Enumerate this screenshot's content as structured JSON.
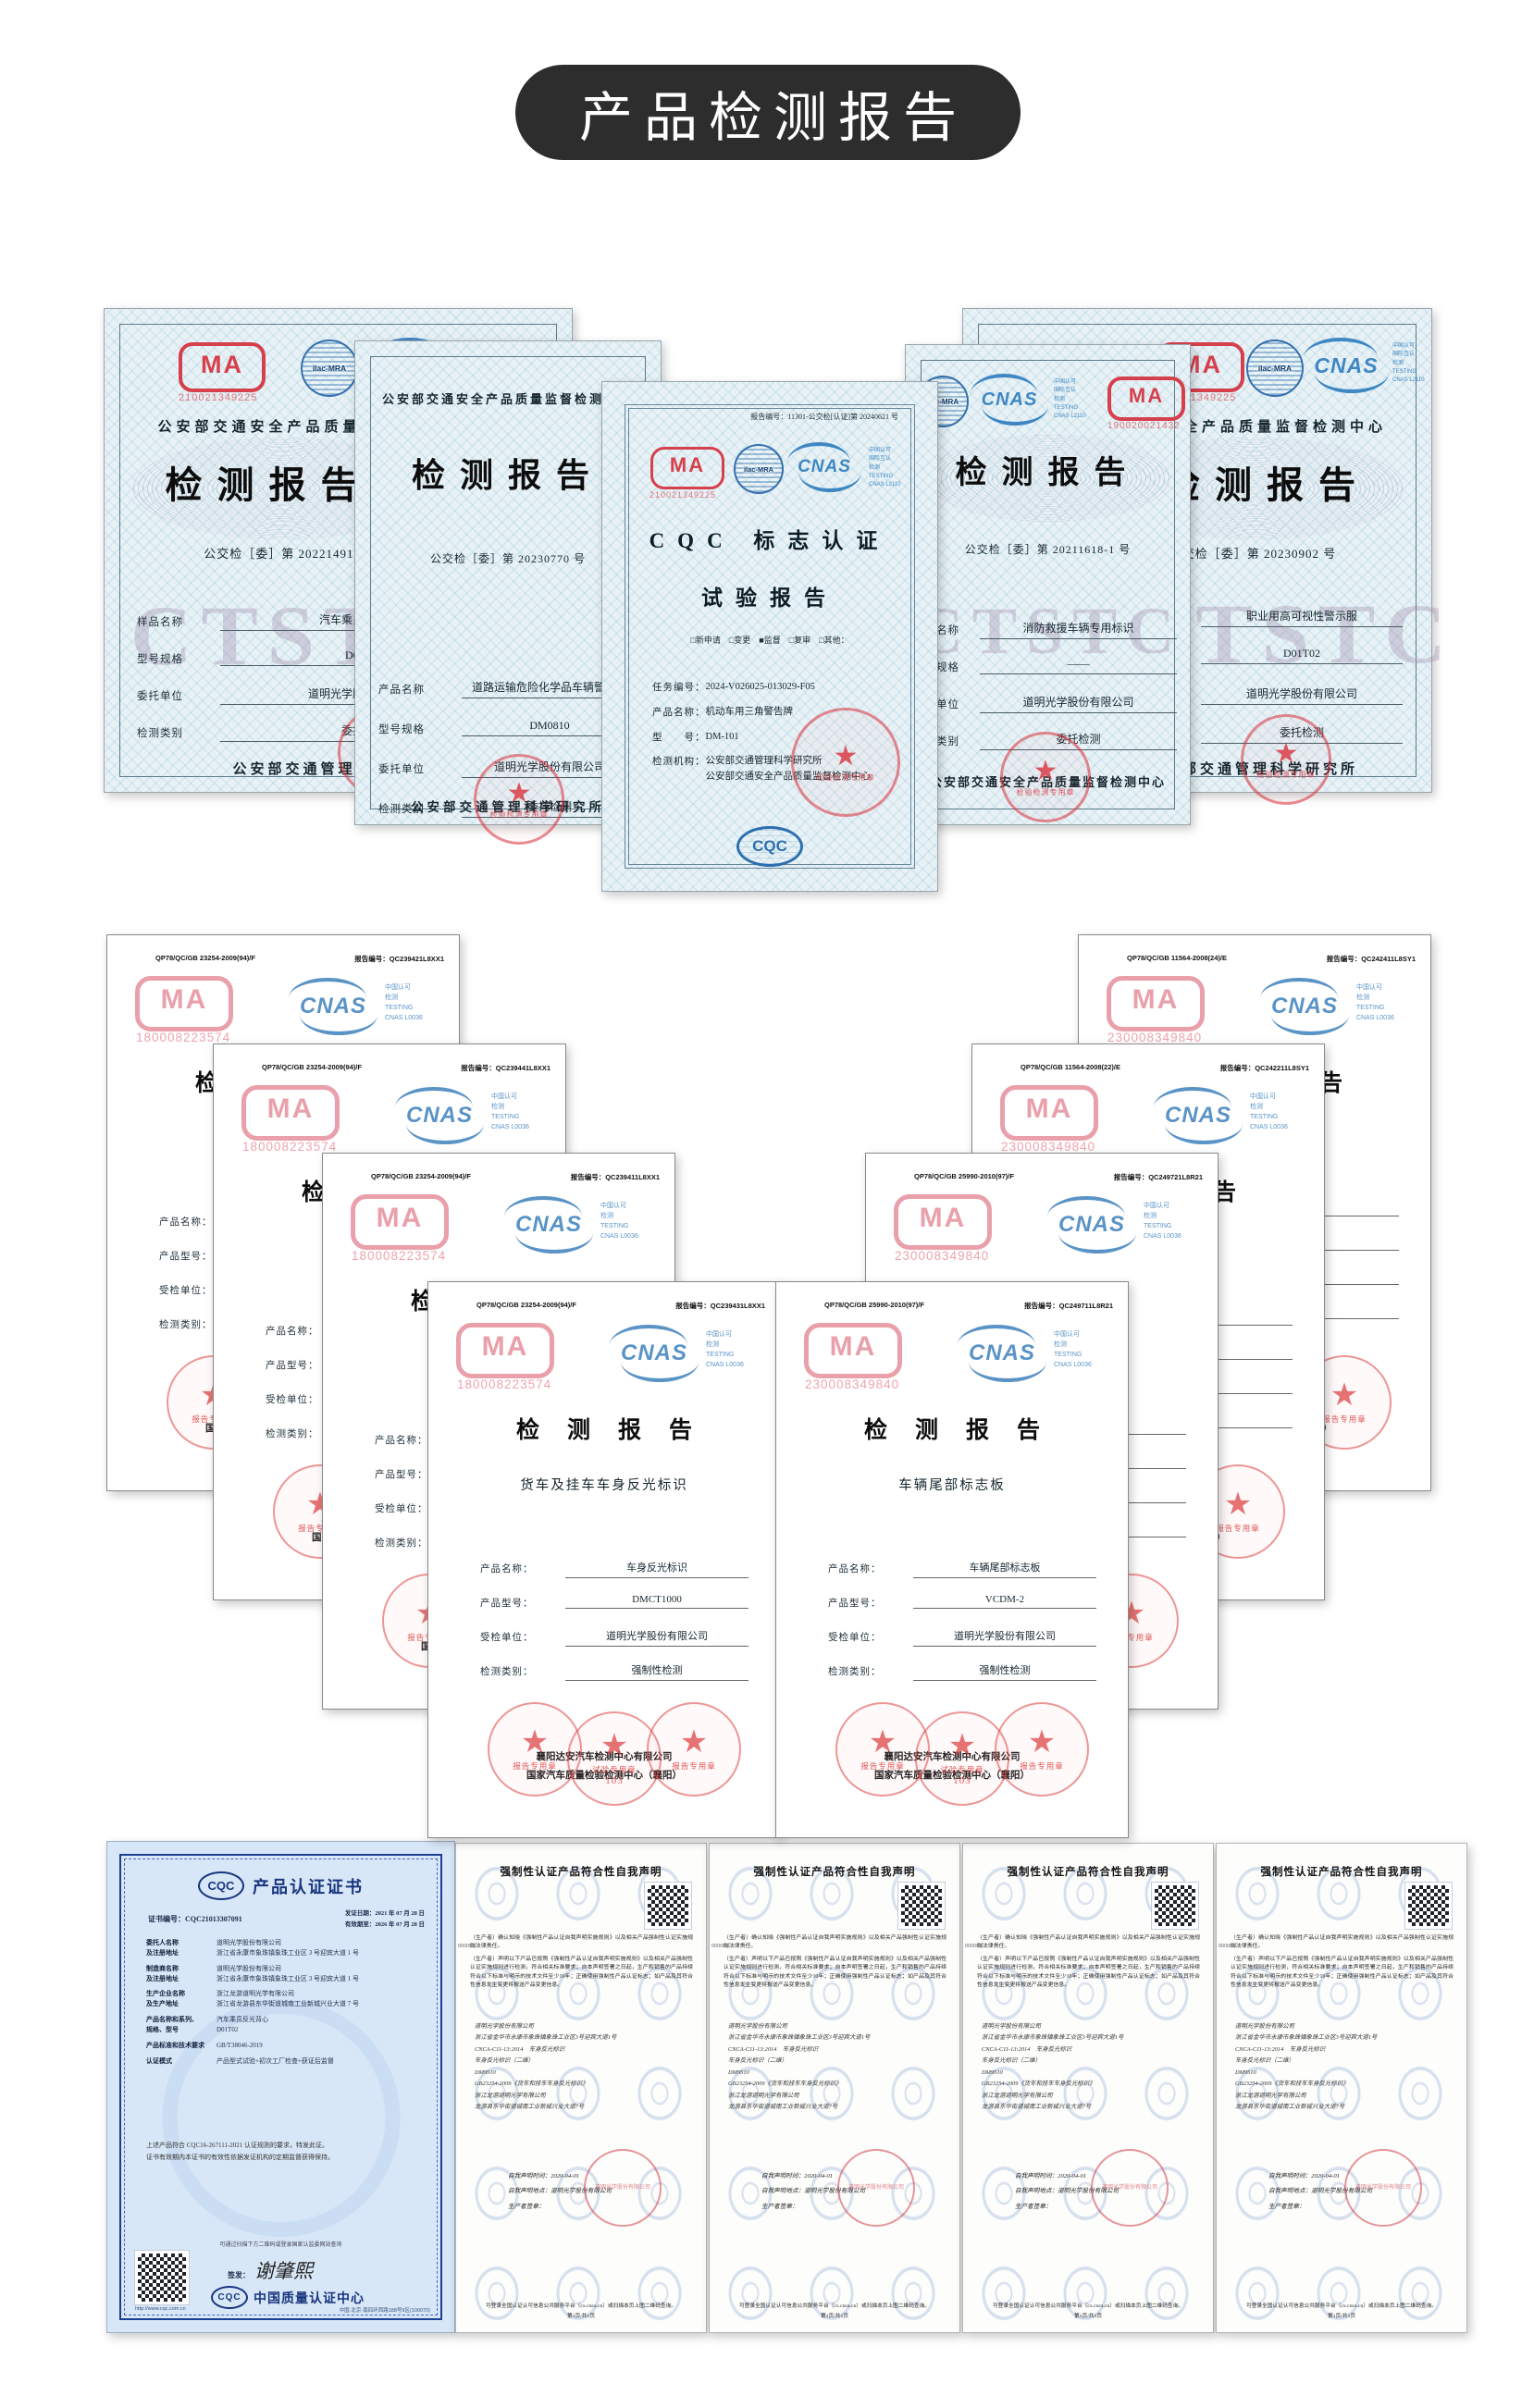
{
  "banner": {
    "title": "产品检测报告"
  },
  "row1": {
    "cma_letters": "MA",
    "certs": [
      {
        "cma_no": "210021349225",
        "ilac": "ilac-MRA",
        "cnas": "CNAS",
        "cnas_txt": "中国认可\n国际互认\n检测\nTESTING\nCNAS L2110",
        "header": "公安部交通安全产品质量监督检测中心",
        "title": "检测报告",
        "doc_no": "公交检［委］第 20221491 号",
        "watermark": "CTSTC",
        "fields": [
          {
            "label": "样品名称",
            "value": "汽车乘员反光背心"
          },
          {
            "label": "型号规格",
            "value": "D01T02"
          },
          {
            "label": "委托单位",
            "value": "道明光学股份有限公司"
          },
          {
            "label": "检测类别",
            "value": "委托检测"
          }
        ],
        "footer": "公安部交通管理科学研究所",
        "seal": "检验检测专用章"
      },
      {
        "header": "公安部交通安全产品质量监督检测中心",
        "title": "检测报告",
        "doc_no": "公交检［委］第 20230770 号",
        "fields": [
          {
            "label": "产品名称",
            "value": "道路运输危险化学品车辆警示牌"
          },
          {
            "label": "型号规格",
            "value": "DM0810"
          },
          {
            "label": "委托单位",
            "value": "道明光学股份有限公司"
          },
          {
            "label": "检测类别",
            "value": "委托检测"
          }
        ],
        "footer": "公安部交通管理科学研究所",
        "seal": "检验检测专用章"
      },
      {
        "report_no": "报告编号：11301-公交检[认证]第 20240621 号",
        "cma_no": "210021349225",
        "ilac": "ilac-MRA",
        "cnas": "CNAS",
        "cnas_txt": "中国认可\n国际互认\n检测\nTESTING\nCNAS L2110",
        "title1": "CQC 标志认证",
        "title2": "试验报告",
        "checks": "□新申请　□变更　■监督　□复审　□其他：",
        "fields": [
          {
            "label": "任务编号：",
            "value": "2024-V026025-013029-F05"
          },
          {
            "label": "产品名称：",
            "value": "机动车用三角警告牌"
          },
          {
            "label": "型　　号：",
            "value": "DM-101"
          },
          {
            "label": "检测机构：",
            "value": "公安部交通管理科学研究所\n公安部交通安全产品质量监督检测中心"
          }
        ],
        "cqc_letters": "CQC",
        "seal": "检验检测专用章"
      },
      {
        "cma_no": "190020021432",
        "ilac": "ilac-MRA",
        "cnas": "CNAS",
        "cnas_txt": "中国认可\n国际互认\n检测\nTESTING\nCNAS L2110",
        "title": "检测报告",
        "doc_no": "公交检［委］第 20211618-1 号",
        "watermark": "CTSTC",
        "fields": [
          {
            "label": "产品名称",
            "value": "消防救援车辆专用标识"
          },
          {
            "label": "型号规格",
            "value": "——"
          },
          {
            "label": "委托单位",
            "value": "道明光学股份有限公司"
          },
          {
            "label": "检测类别",
            "value": "委托检测"
          }
        ],
        "footer": "公安部交通安全产品质量监督检测中心",
        "seal": "检验检测专用章"
      },
      {
        "cma_no": "210021349225",
        "ilac": "ilac-MRA",
        "cnas": "CNAS",
        "cnas_txt": "中国认可\n国际互认\n检测\nTESTING\nCNAS L2110",
        "header": "公安部交通安全产品质量监督检测中心",
        "title": "检测报告",
        "doc_no": "公交检［委］第 20230902 号",
        "watermark": "CTSTC",
        "fields": [
          {
            "label": "产品名称",
            "value": "职业用高可视性警示服"
          },
          {
            "label": "型号规格",
            "value": "D01T02"
          },
          {
            "label": "委托单位",
            "value": "道明光学股份有限公司"
          },
          {
            "label": "检测类别",
            "value": "委托检测"
          }
        ],
        "footer": "公安部交通管理科学研究所",
        "seal": "检验检测专用章"
      }
    ]
  },
  "row2": {
    "common": {
      "report_label": "报告编号：",
      "cma_letters": "MA",
      "cnas": "CNAS",
      "cnas_txt": "中国认可\n检测\nTESTING\nCNAS L0036",
      "title": "检测报告",
      "labels": [
        "产品名称：",
        "产品型号：",
        "受检单位：",
        "检测类别："
      ],
      "org1": "襄阳达安汽车检测中心有限公司",
      "org2": "国家汽车质量检验检测中心（襄阳）",
      "seal1": "报告专用章",
      "seal2": "试验专用章",
      "seal2_num": "103",
      "seal3": "报告专用章"
    },
    "certs": [
      {
        "code": "QP78/QC/GB 23254-2009(94)/F",
        "report_no": "QC239421L8XX1",
        "cma_no": "180008223574",
        "subtitle": "",
        "values": [
          "",
          "",
          "",
          ""
        ]
      },
      {
        "code": "QP78/QC/GB 23254-2009(94)/F",
        "report_no": "QC239441L8XX1",
        "cma_no": "180008223574",
        "subtitle": "",
        "values": [
          "",
          "",
          "",
          ""
        ]
      },
      {
        "code": "QP78/QC/GB 23254-2009(94)/F",
        "report_no": "QC239411L8XX1",
        "cma_no": "180008223574",
        "subtitle": "",
        "values": [
          "",
          "",
          "",
          ""
        ]
      },
      {
        "code": "QP78/QC/GB 23254-2009(94)/F",
        "report_no": "QC239431L8XX1",
        "cma_no": "180008223574",
        "subtitle": "货车及挂车车身反光标识",
        "values": [
          "车身反光标识",
          "DMCT1000",
          "道明光学股份有限公司",
          "强制性检测"
        ]
      },
      {
        "code": "QP78/QC/GB 25990-2010(97)/F",
        "report_no": "QC249711L8R21",
        "cma_no": "230008349840",
        "subtitle": "车辆尾部标志板",
        "values": [
          "车辆尾部标志板",
          "VCDM-2",
          "道明光学股份有限公司",
          "强制性检测"
        ]
      },
      {
        "code": "QP78/QC/GB 25990-2010(97)/F",
        "report_no": "QC249721L8R21",
        "cma_no": "230008349840",
        "subtitle": "",
        "values": [
          "",
          "",
          "",
          ""
        ]
      },
      {
        "code": "QP78/QC/GB 11564-2008(22)/E",
        "report_no": "QC242211L8SY1",
        "cma_no": "230008349840",
        "subtitle": "",
        "values": [
          "",
          "",
          "",
          ""
        ]
      },
      {
        "code": "QP78/QC/GB 11564-2008(24)/E",
        "report_no": "QC242411L8SY1",
        "cma_no": "230008349840",
        "subtitle": "",
        "values": [
          "",
          "",
          "",
          ""
        ]
      }
    ]
  },
  "row3": {
    "cqc": {
      "logo": "CQC",
      "title": "产品认证证书",
      "no_label": "证书编号：CQC21013307091",
      "dates": "发证日期：2021 年 07 月 28 日\n有效期至：2026 年 07 月 28 日",
      "rows": [
        {
          "label": "委托人名称\n及注册地址",
          "value": "道明光学股份有限公司\n浙江省永康市象珠镇象珠工业区 3 号迎宾大道 1 号"
        },
        {
          "label": "制造商名称\n及注册地址",
          "value": "道明光学股份有限公司\n浙江省永康市象珠镇象珠工业区 3 号迎宾大道 1 号"
        },
        {
          "label": "生产企业名称\n及生产地址",
          "value": "浙江龙游道明光学有限公司\n浙江省龙游县东华街道城南工业新城兴业大道 7 号"
        },
        {
          "label": "产品名称和系列、\n规格、型号",
          "value": "汽车乘员反光背心\nD01T02"
        },
        {
          "label": "产品标准和技术要求",
          "value": "GB/T38046-2019"
        },
        {
          "label": "认证模式",
          "value": "产品型式试验+初次工厂检查+获证后监督"
        }
      ],
      "para": "上述产品符合 CQC16-267111-2021 认证规则的要求，特发此证。\n证书有效期内本证书的有效性依据发证机构的定期监督获得保持。",
      "qr_note": "可通过扫描下方二维码或登录国家认监委网站查询",
      "sign_label": "签发：",
      "sign": "谢肇熙",
      "org": "中国质量认证中心",
      "url": "http://www.cqc.com.cn",
      "addr": "中国·北京·南四环西路188号9区(100070)"
    },
    "decl": {
      "title": "强制性认证产品符合性自我声明",
      "number": "000006",
      "para1": "（生产者）确认知晓《强制性产品认证自我声明实施规则》以及相关产品强制性认证实施规则法律责任。",
      "para2": "（生产者）声明以下产品已按照《强制性产品认证自我声明实施规则》以及相关产品强制性认证实施规则进行检测，符合相关标准要求；自本声明签署之日起，生产和销售的产品持续符合以下标准与明示的技术文件至少10年；正确使用强制性产品认证标志；如产品及其符合性信息发生变更将报送产品变更信息。",
      "lines": "道明光学股份有限公司\n浙江省金华市永康市象珠镇象珠工业区3号迎宾大道1号\nCNCA-C11-13:2014　车身反光标识\n车身反光标识（二维）\nDM9510\nGB23254-2009《货车和挂车车身反光标识》\n浙江龙游道明光学有限公司\n龙游县东华街道城南工业新城兴业大道7号",
      "time": "自我声明时间：2020-04-01",
      "place": "自我声明地点：道明光学股份有限公司",
      "sign": "生产者签章：",
      "seal_text": "道明光学股份有限公司",
      "footer1": "可登录全国认证认可信息公共服务平台（cx.cnca.cn）或扫描本页上图二维码查询。",
      "footer2": "第1页/共1页"
    }
  }
}
